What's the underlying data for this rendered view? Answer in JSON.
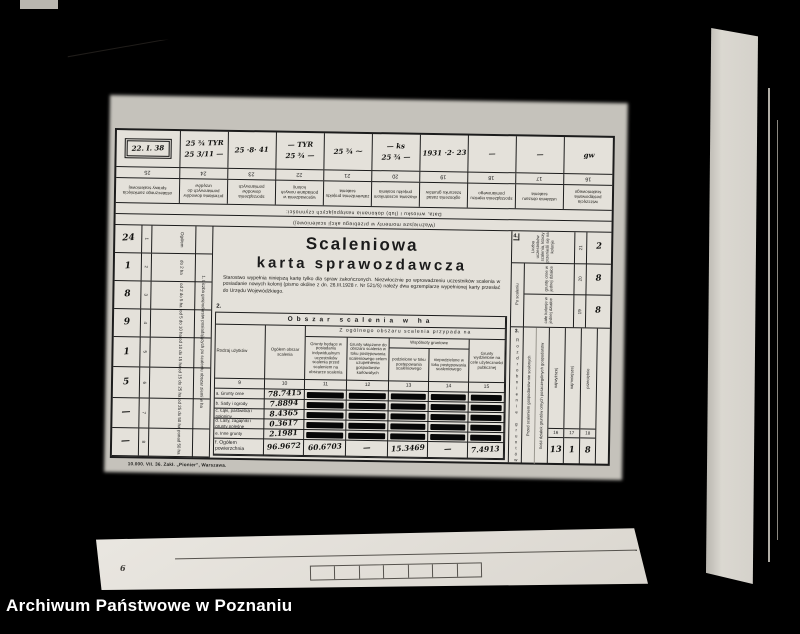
{
  "colors": {
    "background": "#000000",
    "paper": "#e4e1da",
    "ink": "#1c1c1c",
    "caption_text": "#ffffff"
  },
  "photo": {
    "caption": "Archiwum Państwowe w Poznaniu"
  },
  "bottom_sheet": {
    "mark": "6"
  },
  "form": {
    "title1": "Scaleniowa",
    "title2": "karta sprawozdawcza",
    "intro": "Starostwo wypełnia niniejszą kartę tylko dla spraw zakończonych. Niezwłocznie po wprowadzeniu uczestników scalenia w posiadanie nowych kolonij (pismo okólne z dn. 26.III.1928 r. Nr 521/S) należy dwa egzemplarze wypełnionej karty przesłać do Urzędu Wojewódzkiego.",
    "section2_no": "2.",
    "imprint": "10.000. VII. 36.  Zakł. „Pionier”, Warszawa.",
    "top": {
      "cap1": "Data, wniosku i (lub) dokonania następujących czynności:",
      "cap2": "(Ważniejsze momenty w przebiegu akcji scaleniowej)",
      "columns": [
        {
          "num": "25",
          "header": "ostatecznego zamknięcia sprawy scaleniowej",
          "entry1": "22. I. 38",
          "entry2": ""
        },
        {
          "num": "24",
          "header": "przesłania dowodów pomiarowych do urzędów",
          "entry1": "25 ¾ TYR",
          "entry2": "25 3/11 —"
        },
        {
          "num": "23",
          "header": "sporządzenia dowodów pomiarowych",
          "entry1": "25 ·8· 41",
          "entry2": ""
        },
        {
          "num": "22",
          "header": "wprowadzenia w posiadanie nowych kolonij",
          "entry1": "— TYR",
          "entry2": "25 ¾ —"
        },
        {
          "num": "21",
          "header": "zatwierdzenia projektu scalenia",
          "entry1": "25 ¾ ⁓",
          "entry2": ""
        },
        {
          "num": "20",
          "header": "okazania uczestnikom projektu scalenia",
          "entry1": "— ks",
          "entry2": "25 ¾ —"
        },
        {
          "num": "19",
          "header": "ogłoszenia zasad szacunku gruntów",
          "entry1": "1931 ·2· 23",
          "entry2": ""
        },
        {
          "num": "18",
          "header": "sporządzenia rejestru pomiarowego",
          "entry1": "—",
          "entry2": ""
        },
        {
          "num": "17",
          "header": "ustalenia obszaru scalenia",
          "entry1": "—",
          "entry2": ""
        },
        {
          "num": "16",
          "header": "wszczęcia postępowania scaleniowego",
          "entry1": "gw",
          "entry2": ""
        }
      ]
    },
    "left": {
      "header": "1. Liczba gospodarstw posiadających po scaleniu obszar ziemi w ha",
      "rows": [
        {
          "label": "Ogółem",
          "num": "1",
          "value": "24"
        },
        {
          "label": "do 2 ha",
          "num": "2",
          "value": "1"
        },
        {
          "label": "od 2 do 5 ha",
          "num": "3",
          "value": "8"
        },
        {
          "label": "od 5 do 10 ha",
          "num": "4",
          "value": "9"
        },
        {
          "label": "od 10 do 15 ha",
          "num": "5",
          "value": "1"
        },
        {
          "label": "od 15 do 25 ha",
          "num": "6",
          "value": "5"
        },
        {
          "label": "od 25 do 50 ha",
          "num": "7",
          "value": "—"
        },
        {
          "label": "ponad 50 ha",
          "num": "8",
          "value": "—"
        }
      ]
    },
    "table": {
      "banner": "Obszar scalenia w ha",
      "sub_banner": "Z ogólnego obszaru scalenia przypada na",
      "col9": "Rodzaj użytków",
      "col10": "Ogółem obszar scalenia",
      "col11": "Grunty będące w posiadaniu indywidualnym uczestników scalenia przed scaleniem na obszarze scalenia",
      "col12": "Grunty włączone do obszaru scalenia w toku postępowania scaleniowego celem uzupełnienia gospodarstw karłowatych",
      "wspolnoty": "Wspólnoty gruntowe",
      "col13": "podzielone w toku postępowania scaleniowego",
      "col14": "niepodzielone w toku postępowania scaleniowego",
      "col15": "Grunty wydzielone na cele użyteczności publicznej",
      "numbers": [
        "9",
        "10",
        "11",
        "12",
        "13",
        "14",
        "15"
      ],
      "rows": [
        {
          "label": "a. Grunty orne",
          "total": "78.7415"
        },
        {
          "label": "b. Sady i ogrody",
          "total": "7.8894"
        },
        {
          "label": "c. Łąki, pastwiska i połoniny",
          "total": "8.4365"
        },
        {
          "label": "d. Lasy, zagajniki i grunty poleśne",
          "total": "0.3617"
        },
        {
          "label": "e. Inne grunty",
          "total": "2.1981"
        }
      ],
      "total_row": {
        "label": "f. Ogółem powierzchnia",
        "values": [
          "96.9672",
          "60.6703",
          "—",
          "15.3469",
          "—",
          "7.4913"
        ]
      }
    },
    "right": {
      "s4": {
        "no": "4.",
        "sub1": "Po scaleniu",
        "sub2": "Liczba uczestników scalenia posiadających",
        "rows": [
          {
            "label": "Liczba uczestników scalenia, którzy przenieśli się na kolonje",
            "num": "21",
            "value": "2"
          },
          {
            "label": "grunty orne w jednej działce",
            "num": "20",
            "value": "8"
          },
          {
            "label": "całe kolonje w jednej działce",
            "num": "19",
            "value": "8"
          }
        ]
      },
      "s3": {
        "no": "3.",
        "vertical": "Rozdrobnienie gruntów",
        "h1": "Przed scaleniem gospodarstw nie scalonych",
        "h2": "Ilość działek gruntów ornych poszczególnych gospodarstw",
        "cols": [
          {
            "label": "najwyższej",
            "num": "16",
            "value": "13"
          },
          {
            "label": "najmniejszej",
            "num": "17",
            "value": "1"
          },
          {
            "label": "przeciętnie",
            "num": "18",
            "value": "8"
          }
        ]
      }
    }
  }
}
